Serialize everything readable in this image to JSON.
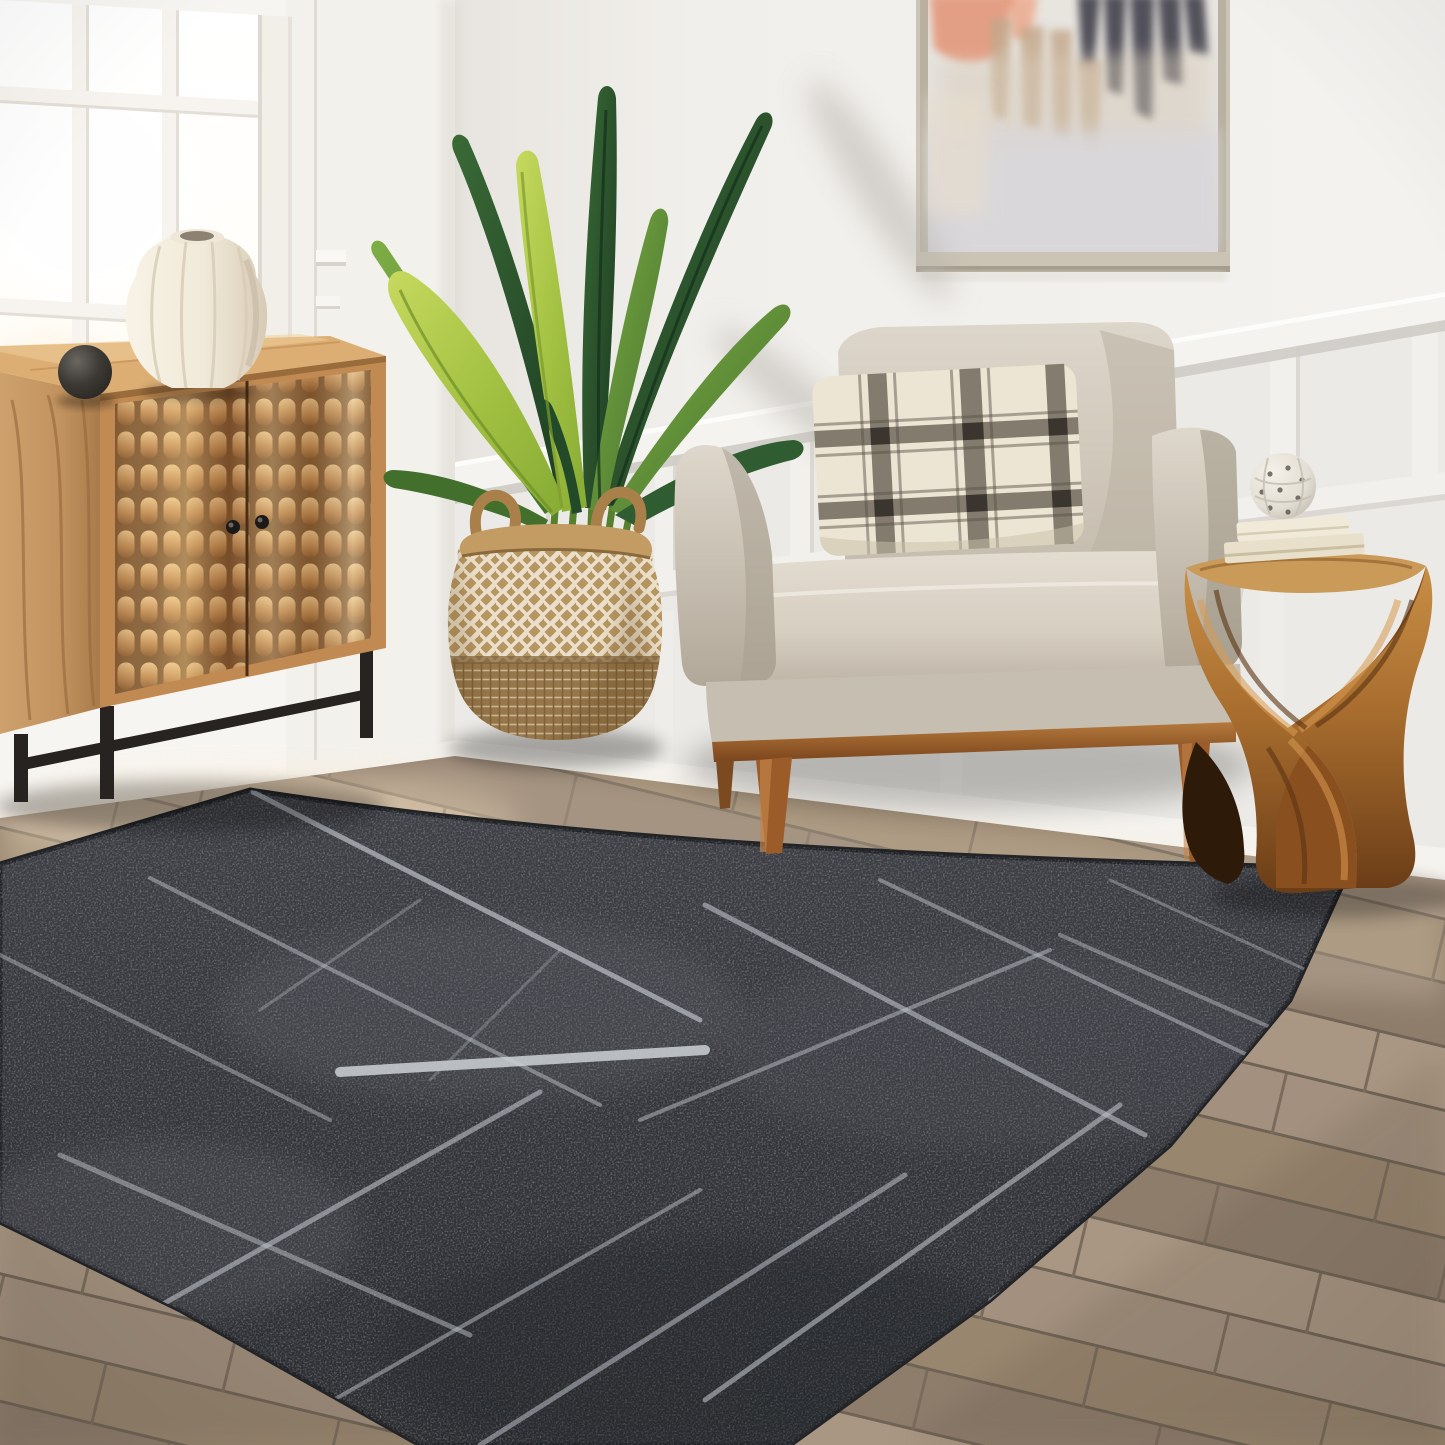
{
  "scene": {
    "title": "Living room with charcoal abstract-line area rug, beige armchair, carved wood cabinet, bird of paradise plant and twisted wood side table",
    "objects": [
      {
        "name": "window",
        "desc": "bright paned window, white muntins"
      },
      {
        "name": "cabinet",
        "desc": "carved mango-wood 2-door cabinet on black metal base"
      },
      {
        "name": "vase",
        "desc": "cream fluted ceramic vase"
      },
      {
        "name": "sphere-decor",
        "desc": "black wooden sphere"
      },
      {
        "name": "plant",
        "desc": "bird of paradise in woven two-tone belly basket"
      },
      {
        "name": "painting",
        "desc": "abstract art, salmon/charcoal/tan strokes, champagne frame"
      },
      {
        "name": "armchair",
        "desc": "greige slope-arm chair, wood tapered legs"
      },
      {
        "name": "pillow",
        "desc": "cream windowpane plaid lumbar pillow"
      },
      {
        "name": "side-table",
        "desc": "twisted solid wood stool with books and carved ball"
      },
      {
        "name": "rug",
        "desc": "charcoal gray rug with light gray abstract crossing lines"
      },
      {
        "name": "floor",
        "desc": "gray-brown wood plank flooring"
      }
    ]
  },
  "palette": {
    "wallLeft": "#f7f5f1",
    "wallRight": "#f0eeea",
    "wallShade": "#d9d5cf",
    "wainscot": "#eceae6",
    "trim": "#f5f3ef",
    "baseboard": "#f5f3ef",
    "glass": "#ffffff",
    "glassWarm": "#fcefdc",
    "frame": "#f2efe9",
    "floorA": "#a3907e",
    "floorB": "#99866f",
    "floorC": "#8f7d6c",
    "floorD": "#aa9783",
    "floorGap": "#6f6355",
    "rugBase": "#37383e",
    "rugDark": "#2c2d31",
    "rugLine": "#bcc0c6",
    "rugEdge": "#222327",
    "cabTop": "#dcae74",
    "cabSide": "#c2935f",
    "cabFace": "#c08a52",
    "carveHi": "#e9c48c",
    "carveLo": "#7c5530",
    "metal": "#262320",
    "vase": "#f3ede0",
    "vaseShade": "#d7cbb6",
    "sphere": "#33302c",
    "basket": "#b7955f",
    "weave": "#eadfca",
    "basketDark": "#97774a",
    "leafBrightA": "#b6ce4e",
    "leafBrightB": "#86ab34",
    "leafMidA": "#6f9e3a",
    "leafMidB": "#426f2c",
    "leafDarkA": "#305c30",
    "leafDarkB": "#1c3b22",
    "stem": "#567f2e",
    "chairHi": "#e0d9cd",
    "chairMid": "#d3cbbe",
    "chairLo": "#b4ab9d",
    "chairDeep": "#968c7d",
    "pillowBase": "#ede5d3",
    "pillowBand": "#7b7466",
    "pillowDark": "#3a352f",
    "legWood": "#9c5c29",
    "legHi": "#c28349",
    "tableHi": "#d09b53",
    "tableMid": "#a86d2e",
    "tableDark": "#6b3d17",
    "tableDeep": "#452508",
    "bookA": "#e8e0cb",
    "bookB": "#f1ead9",
    "ball": "#e3ded3",
    "frameCol": "#cbc4b5",
    "canvas": "#e8e4de",
    "salmon": "#e3987c",
    "charcoal": "#3e3c48",
    "tanP": "#c3a78a",
    "lightP": "#d9d7da"
  }
}
